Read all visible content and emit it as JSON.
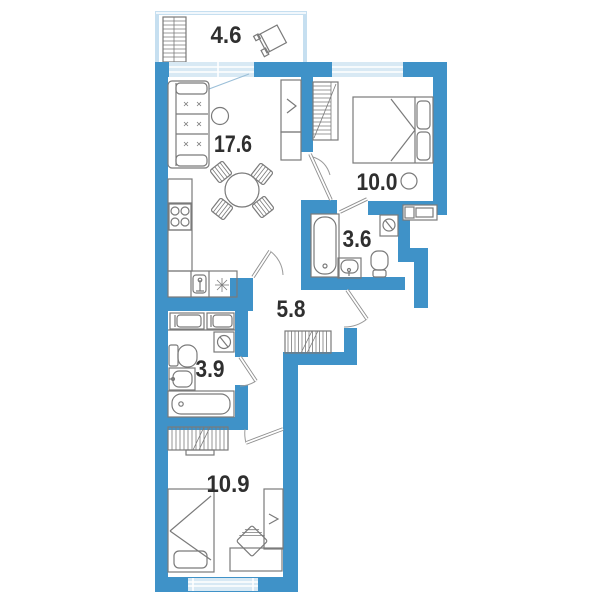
{
  "plan": {
    "canvas": {
      "width": 600,
      "height": 600,
      "background": "#ffffff"
    },
    "colors": {
      "wall": "#3F92C8",
      "balconyWall": "#C6DFF0",
      "window": "#D8E9F4",
      "windowFrame": "#FFFFFF",
      "furniture": "#7A7A7A",
      "label": "#2F2F2F"
    },
    "rooms": [
      {
        "name": "balcony",
        "area": "4.6"
      },
      {
        "name": "living-kitchen",
        "area": "17.6"
      },
      {
        "name": "bedroom-1",
        "area": "10.0"
      },
      {
        "name": "bathroom-1",
        "area": "3.6"
      },
      {
        "name": "hallway",
        "area": "5.8"
      },
      {
        "name": "bathroom-2",
        "area": "3.9"
      },
      {
        "name": "bedroom-2",
        "area": "10.9"
      }
    ]
  }
}
